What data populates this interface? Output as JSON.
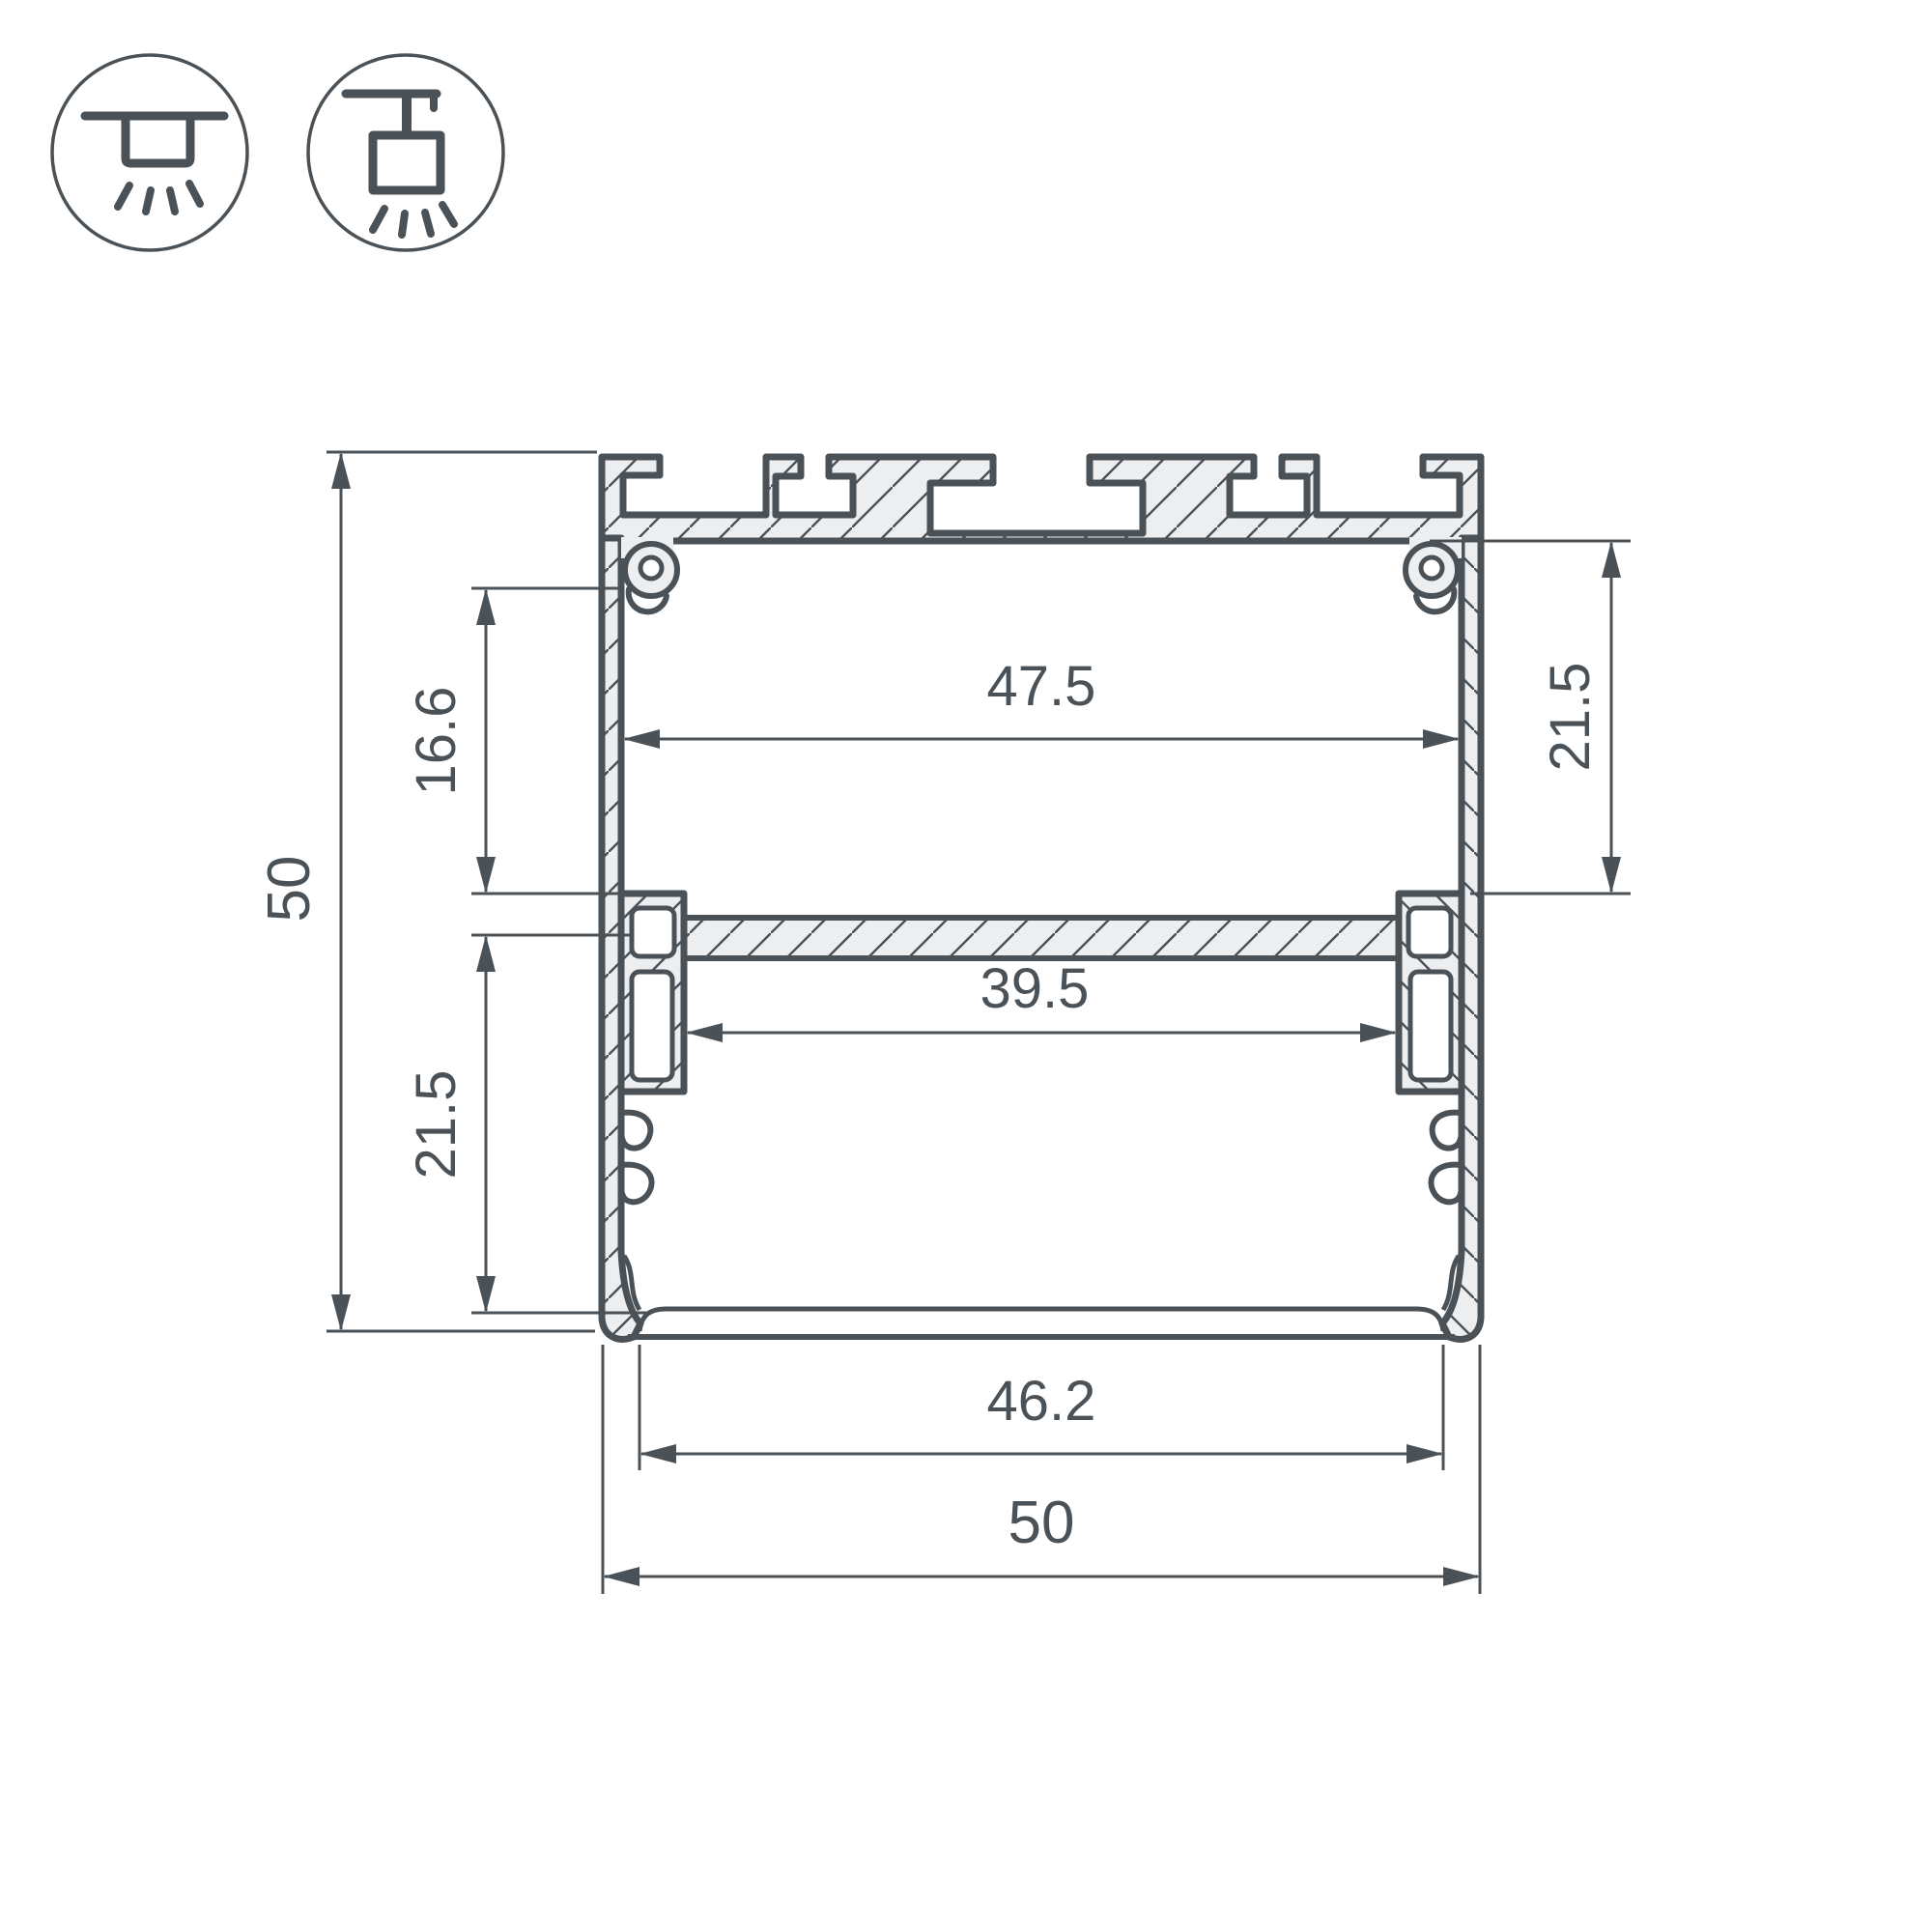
{
  "colors": {
    "line": "#4b5257",
    "aluminum_fill": "#edeef0",
    "background": "#ffffff"
  },
  "icons": [
    {
      "name": "surface-mount-icon",
      "meaning": "surface mounted luminaire"
    },
    {
      "name": "pendant-mount-icon",
      "meaning": "suspended luminaire"
    }
  ],
  "dimensions": {
    "overall_height": "50",
    "upper_inner_height": "16.6",
    "lower_inner_height": "21.5",
    "right_inner_height": "21.5",
    "upper_inner_width": "47.5",
    "lower_inner_width": "39.5",
    "bottom_opening_width": "46.2",
    "overall_width": "50"
  }
}
